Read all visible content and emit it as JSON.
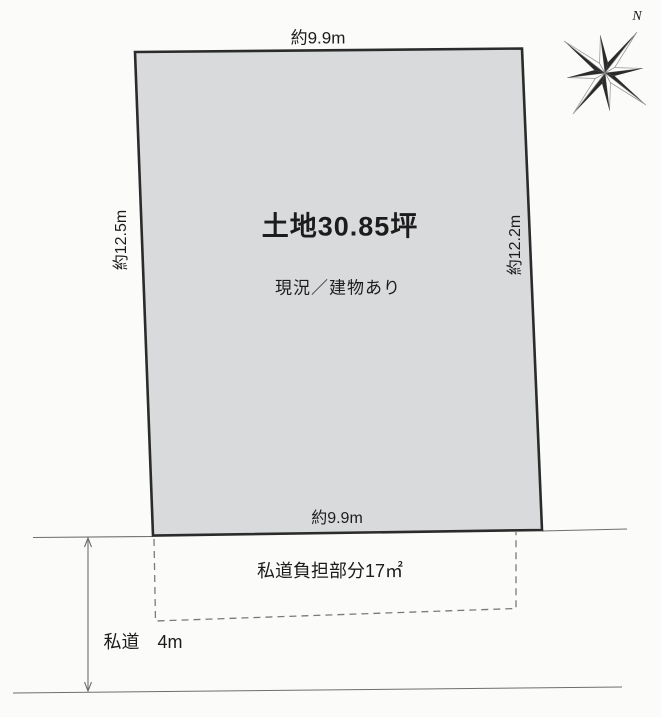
{
  "compass": {
    "north_label": "N"
  },
  "parcel": {
    "area_label": "土地30.85坪",
    "status_label": "現況／建物あり",
    "top_width": "約9.9m",
    "bottom_width": "約9.9m",
    "left_width": "約12.5m",
    "right_width": "約12.2m"
  },
  "road": {
    "burden_label": "私道負担部分17㎡",
    "width_label": "私道　4m"
  },
  "colors": {
    "background": "#fbfbf9",
    "parcel_fill": "#d9dadc",
    "parcel_border": "#2b2b2b",
    "line": "#6e6e6e",
    "text": "#1c1c1c"
  }
}
